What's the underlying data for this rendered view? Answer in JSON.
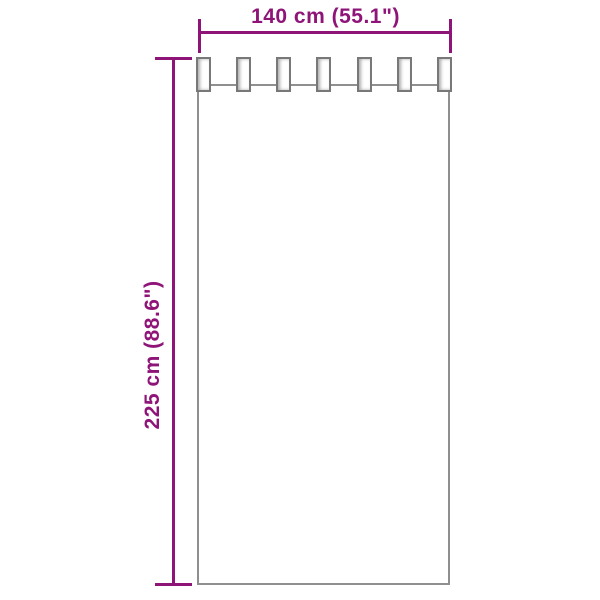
{
  "diagram": {
    "type": "product-dimension-diagram",
    "subject": "tab-top curtain",
    "width_label": "140 cm (55.1\")",
    "height_label": "225 cm (88.6\")",
    "dimensions": {
      "width_cm": 140,
      "width_in": 55.1,
      "height_cm": 225,
      "height_in": 88.6
    }
  },
  "curtain": {
    "tab_count": 7
  },
  "colors": {
    "dimension_accent": "#8E1478",
    "curtain_outline": "#8f8f8f",
    "tab_outline": "#787878",
    "background": "#ffffff"
  }
}
